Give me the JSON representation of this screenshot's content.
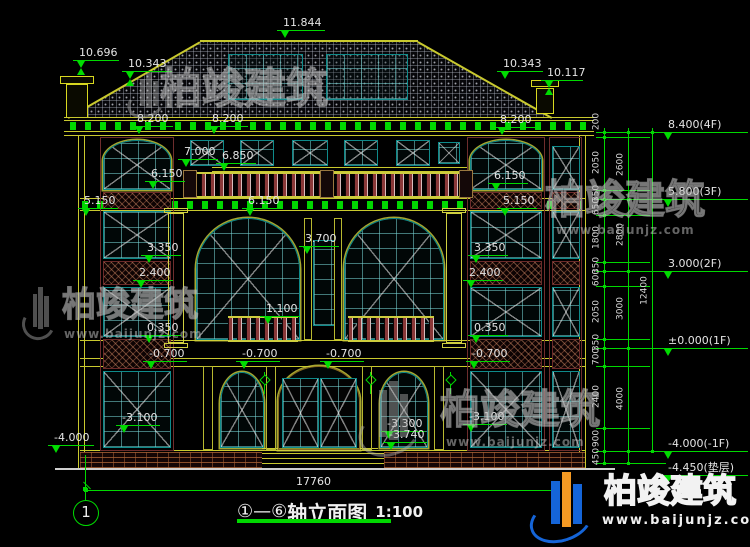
{
  "drawing_title": {
    "axis_prefix": "①—⑥",
    "name": "轴立面图",
    "scale": "1:100"
  },
  "axis_bubble": {
    "label": "1"
  },
  "overall_dim": {
    "text": "17760"
  },
  "watermark_brand": {
    "name": "柏竣建筑",
    "url": "www.baijunjz.com"
  },
  "colors": {
    "cad_green": "#00dc00",
    "cad_yellow": "#c9c92e",
    "teal": "#0e8b8b",
    "maroon": "#7a3030",
    "dim_text": "#e4e4e4",
    "brand_blue": "#1565d8",
    "brand_orange": "#f59a23"
  },
  "right_levels": [
    {
      "t": "8.400(4F)",
      "y": 132
    },
    {
      "t": "5.800(3F)",
      "y": 199
    },
    {
      "t": "3.000(2F)",
      "y": 271
    },
    {
      "t": "±0.000(1F)",
      "y": 348
    },
    {
      "t": "-4.000(-1F)",
      "y": 451
    },
    {
      "t": "-4.450(垫层)",
      "y": 475
    }
  ],
  "elevation_marks": [
    {
      "t": "11.844",
      "x": 277,
      "y": 30,
      "w": 48,
      "m": "tri"
    },
    {
      "t": "10.696",
      "x": 73,
      "y": 60,
      "w": 46,
      "m": "hg"
    },
    {
      "t": "10.343",
      "x": 122,
      "y": 71,
      "w": 50,
      "m": "hg"
    },
    {
      "t": "10.343",
      "x": 497,
      "y": 71,
      "w": 46,
      "m": "tri"
    },
    {
      "t": "10.117",
      "x": 541,
      "y": 80,
      "w": 42,
      "m": "hg"
    },
    {
      "t": "8.200",
      "x": 131,
      "y": 126,
      "w": 42,
      "m": "tri"
    },
    {
      "t": "8.200",
      "x": 206,
      "y": 126,
      "w": 42,
      "m": "tri"
    },
    {
      "t": "8.200",
      "x": 494,
      "y": 127,
      "w": 42,
      "m": "tri"
    },
    {
      "t": "7.000",
      "x": 178,
      "y": 159,
      "w": 40,
      "m": "tri"
    },
    {
      "t": "6.850",
      "x": 216,
      "y": 163,
      "w": 40,
      "m": "tri"
    },
    {
      "t": "6.150",
      "x": 145,
      "y": 181,
      "w": 40,
      "m": "tri"
    },
    {
      "t": "6.150",
      "x": 488,
      "y": 183,
      "w": 40,
      "m": "tri"
    },
    {
      "t": "5.150",
      "x": 78,
      "y": 208,
      "w": 40,
      "m": "tri"
    },
    {
      "t": "6.150",
      "x": 242,
      "y": 208,
      "w": 40,
      "m": "tri"
    },
    {
      "t": "5.150",
      "x": 497,
      "y": 208,
      "w": 40,
      "m": "tri"
    },
    {
      "t": "3.700",
      "x": 299,
      "y": 246,
      "w": 40,
      "m": "tri"
    },
    {
      "t": "3.350",
      "x": 141,
      "y": 255,
      "w": 40,
      "m": "tri"
    },
    {
      "t": "3.350",
      "x": 468,
      "y": 255,
      "w": 40,
      "m": "tri"
    },
    {
      "t": "2.400",
      "x": 133,
      "y": 280,
      "w": 40,
      "m": "tri"
    },
    {
      "t": "2.400",
      "x": 463,
      "y": 280,
      "w": 40,
      "m": "tri"
    },
    {
      "t": "1.100",
      "x": 260,
      "y": 316,
      "w": 40,
      "m": "tri"
    },
    {
      "t": "0.350",
      "x": 141,
      "y": 335,
      "w": 40,
      "m": "tri"
    },
    {
      "t": "0.350",
      "x": 468,
      "y": 335,
      "w": 40,
      "m": "tri"
    },
    {
      "t": "-0.700",
      "x": 143,
      "y": 361,
      "w": 44,
      "m": "tri"
    },
    {
      "t": "-0.700",
      "x": 236,
      "y": 361,
      "w": 44,
      "m": "tri"
    },
    {
      "t": "-0.700",
      "x": 320,
      "y": 361,
      "w": 44,
      "m": "tri"
    },
    {
      "t": "-0.700",
      "x": 466,
      "y": 361,
      "w": 44,
      "m": "tri"
    },
    {
      "t": "-3.100",
      "x": 116,
      "y": 425,
      "w": 44,
      "m": "tri"
    },
    {
      "t": "-3.100",
      "x": 463,
      "y": 424,
      "w": 44,
      "m": "tri"
    },
    {
      "t": "-3.300",
      "x": 381,
      "y": 431,
      "w": 44,
      "m": "tri"
    },
    {
      "t": "-3.740",
      "x": 383,
      "y": 442,
      "w": 44,
      "m": "tri"
    },
    {
      "t": "-4.000",
      "x": 48,
      "y": 445,
      "w": 46,
      "m": "tri"
    }
  ],
  "dim_chains": {
    "columns": [
      {
        "x": 604,
        "top": 128,
        "bot": 463,
        "dots": [
          132,
          137,
          190,
          199,
          215,
          262,
          271,
          286,
          339,
          348,
          366,
          428,
          451,
          463
        ],
        "labels": [
          [
            "200",
            122
          ],
          [
            "2050",
            163
          ],
          [
            "350",
            194
          ],
          [
            "650",
            207
          ],
          [
            "1800",
            238
          ],
          [
            "350",
            266
          ],
          [
            "600",
            278
          ],
          [
            "2050",
            312
          ],
          [
            "350",
            343
          ],
          [
            "700",
            357
          ],
          [
            "2400",
            397
          ],
          [
            "900",
            439
          ],
          [
            "450",
            457
          ]
        ]
      },
      {
        "x": 628,
        "top": 128,
        "bot": 463,
        "dots": [
          132,
          199,
          271,
          348,
          451,
          463
        ],
        "labels": [
          [
            "2600",
            165
          ],
          [
            "2800",
            235
          ],
          [
            "3000",
            309
          ],
          [
            "4000",
            399
          ]
        ]
      },
      {
        "x": 652,
        "top": 128,
        "bot": 451,
        "dots": [
          132,
          451
        ],
        "labels": [
          [
            "12400",
            291
          ]
        ]
      }
    ],
    "hlines": [
      [
        596,
        132,
        70
      ],
      [
        596,
        137,
        54
      ],
      [
        596,
        190,
        54
      ],
      [
        596,
        199,
        70
      ],
      [
        596,
        215,
        54
      ],
      [
        596,
        262,
        54
      ],
      [
        596,
        271,
        70
      ],
      [
        596,
        286,
        54
      ],
      [
        596,
        339,
        54
      ],
      [
        596,
        348,
        70
      ],
      [
        596,
        366,
        54
      ],
      [
        596,
        428,
        54
      ],
      [
        596,
        451,
        70
      ],
      [
        596,
        463,
        70
      ]
    ]
  },
  "bottom_dim": {
    "x1": 86,
    "x2": 554,
    "y": 490,
    "tx": 296,
    "ty": 476
  },
  "bubble_geo": {
    "leader_x": 85,
    "leader_y1": 455,
    "leader_y2": 501
  },
  "watermarks": [
    {
      "kind": "gray",
      "logo": [
        130,
        70,
        34,
        48
      ],
      "tx": 160,
      "ty": 68,
      "ts": 42
    },
    {
      "kind": "gray",
      "logo": [
        24,
        284,
        30,
        56
      ],
      "tx": 62,
      "ty": 288,
      "ts": 34,
      "ux": 64,
      "uy": 328,
      "us": 12
    },
    {
      "kind": "gray",
      "tx": 545,
      "ty": 180,
      "ts": 40,
      "ux": 556,
      "uy": 224,
      "us": 12
    },
    {
      "kind": "gray",
      "logo": [
        362,
        376,
        56,
        80
      ],
      "tx": 440,
      "ty": 390,
      "ts": 40,
      "ux": 446,
      "uy": 436,
      "us": 12
    },
    {
      "kind": "brand",
      "logo": [
        534,
        468,
        58,
        74
      ],
      "tx": 604,
      "ty": 474,
      "ts": 33,
      "ux": 602,
      "uy": 514,
      "us": 13
    }
  ],
  "drawing": {
    "roof": {
      "box": [
        60,
        38,
        500,
        84
      ],
      "clip": "polygon(140px 4px,358px 4px,492px 80px,8px 80px)",
      "ridge": [
        200,
        40,
        218,
        2
      ]
    },
    "attic_windows": [
      [
        228,
        54,
        75,
        46
      ],
      [
        326,
        54,
        82,
        46
      ]
    ],
    "chimneys": [
      {
        "body": [
          66,
          84,
          22,
          34
        ],
        "cap": [
          60,
          76,
          34,
          8
        ]
      },
      {
        "body": [
          536,
          88,
          18,
          26
        ],
        "cap": [
          531,
          80,
          28,
          7
        ]
      }
    ],
    "gsq_bands": [
      [
        70,
        122,
        520,
        8
      ],
      [
        82,
        201,
        500,
        8
      ]
    ],
    "ylines": [
      [
        64,
        117,
        530,
        1
      ],
      [
        64,
        120,
        530,
        1
      ],
      [
        64,
        131,
        530,
        1
      ],
      [
        64,
        135,
        530,
        1
      ],
      [
        212,
        167,
        256,
        1
      ],
      [
        212,
        171,
        256,
        1
      ],
      [
        80,
        198,
        505,
        1
      ],
      [
        80,
        210,
        505,
        1
      ],
      [
        80,
        340,
        505,
        1
      ],
      [
        80,
        358,
        505,
        1
      ],
      [
        80,
        366,
        505,
        1
      ],
      [
        80,
        450,
        505,
        1
      ],
      [
        262,
        448,
        116,
        1
      ],
      [
        256,
        453,
        128,
        1
      ],
      [
        250,
        458,
        140,
        1
      ],
      [
        246,
        463,
        148,
        1
      ]
    ],
    "vlines": [
      [
        78,
        135,
        1,
        333
      ],
      [
        84,
        135,
        1,
        333
      ],
      [
        579,
        135,
        1,
        333
      ],
      [
        585,
        135,
        1,
        333
      ]
    ],
    "ground": [
      55,
      468,
      560,
      2
    ],
    "bayframes": [
      [
        100,
        137,
        74,
        314
      ],
      [
        467,
        137,
        78,
        314
      ],
      [
        549,
        137,
        33,
        314
      ]
    ],
    "windows_x": [
      [
        190,
        140,
        34,
        26
      ],
      [
        240,
        140,
        34,
        26
      ],
      [
        292,
        140,
        36,
        26
      ],
      [
        344,
        140,
        34,
        26
      ],
      [
        396,
        140,
        34,
        26
      ],
      [
        438,
        142,
        22,
        22
      ],
      [
        103,
        211,
        68,
        48
      ],
      [
        103,
        287,
        68,
        50
      ],
      [
        103,
        371,
        68,
        77
      ],
      [
        470,
        211,
        72,
        48
      ],
      [
        470,
        287,
        72,
        50
      ],
      [
        470,
        371,
        72,
        77
      ],
      [
        552,
        146,
        28,
        44
      ],
      [
        552,
        211,
        28,
        48
      ],
      [
        552,
        287,
        28,
        50
      ],
      [
        552,
        371,
        28,
        77
      ]
    ],
    "windows_arch": [
      [
        103,
        140,
        68,
        50
      ],
      [
        470,
        140,
        72,
        50
      ],
      [
        196,
        218,
        104,
        122
      ],
      [
        344,
        218,
        100,
        122
      ],
      [
        220,
        372,
        44,
        76
      ],
      [
        380,
        372,
        48,
        76
      ]
    ],
    "windows_plain": [
      [
        313,
        240,
        22,
        86
      ]
    ],
    "panels": [
      [
        103,
        192,
        68,
        17
      ],
      [
        470,
        192,
        72,
        17
      ],
      [
        552,
        192,
        28,
        17
      ],
      [
        103,
        261,
        68,
        24
      ],
      [
        470,
        261,
        72,
        24
      ],
      [
        552,
        261,
        28,
        24
      ],
      [
        103,
        339,
        68,
        30
      ],
      [
        470,
        339,
        72,
        30
      ],
      [
        552,
        339,
        28,
        30
      ]
    ],
    "balustrades": [
      [
        183,
        172,
        290,
        26
      ],
      [
        228,
        316,
        70,
        26
      ],
      [
        348,
        316,
        86,
        26
      ]
    ],
    "pedestals": [
      [
        183,
        170,
        14,
        28
      ],
      [
        320,
        170,
        14,
        28
      ],
      [
        459,
        170,
        14,
        28
      ]
    ],
    "columns": [
      [
        168,
        213,
        16,
        130
      ],
      [
        446,
        213,
        16,
        130
      ]
    ],
    "pilasters": [
      [
        304,
        218,
        8,
        122
      ],
      [
        334,
        218,
        8,
        122
      ],
      [
        203,
        366,
        10,
        84
      ],
      [
        266,
        366,
        10,
        84
      ],
      [
        362,
        366,
        10,
        84
      ],
      [
        434,
        366,
        10,
        84
      ]
    ],
    "door": {
      "frame": [
        278,
        366,
        82,
        84
      ],
      "leaves": [
        [
          282,
          378,
          37,
          70
        ],
        [
          320,
          378,
          37,
          70
        ]
      ]
    },
    "lamps": [
      [
        260,
        372
      ],
      [
        366,
        372
      ],
      [
        446,
        372
      ]
    ],
    "bricks": [
      [
        80,
        452,
        182,
        16
      ],
      [
        384,
        452,
        201,
        16
      ]
    ],
    "title_underline": [
      237,
      519,
      154,
      4
    ]
  }
}
